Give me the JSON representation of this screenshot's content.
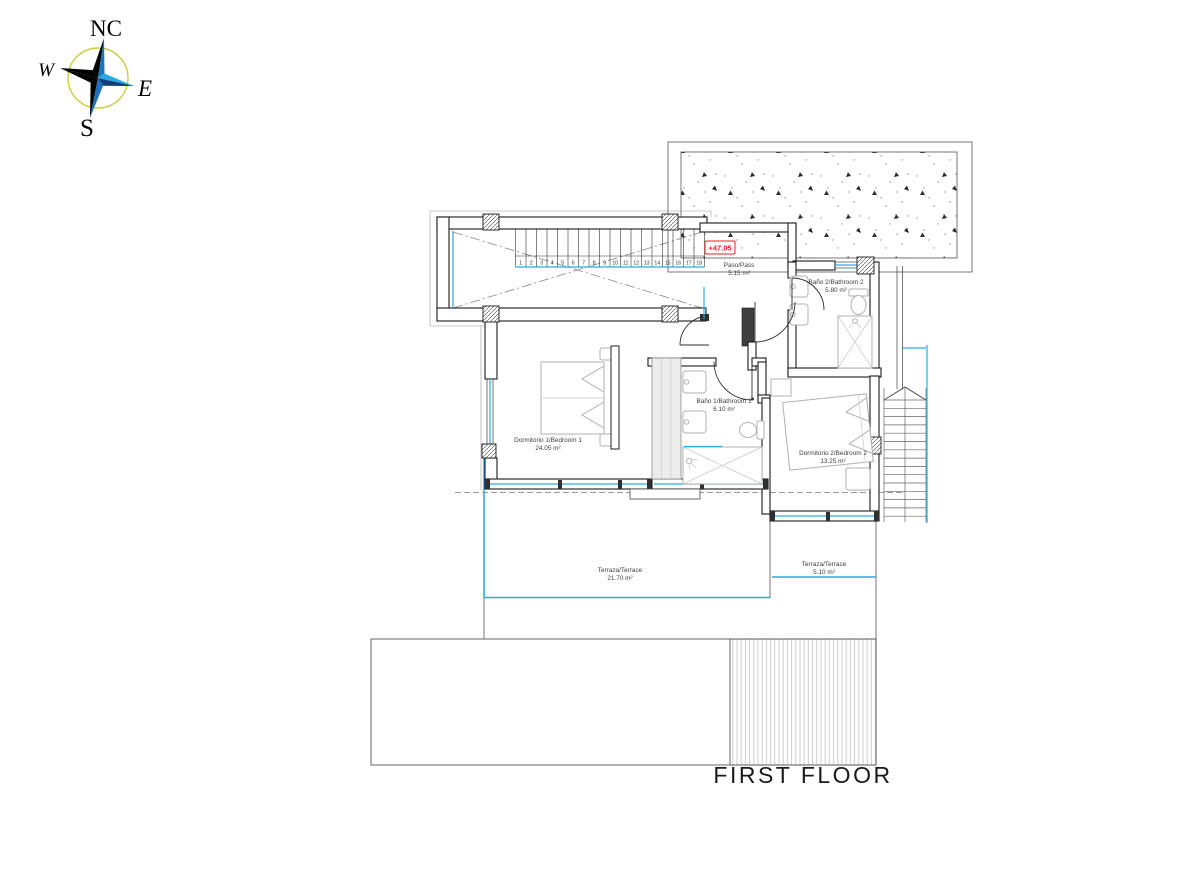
{
  "title": "FIRST FLOOR",
  "level_marker": "+47.05",
  "compass": {
    "north": "NC",
    "west": "W",
    "east": "E",
    "south": "S"
  },
  "rooms": {
    "paso": {
      "name": "Paso/Pass",
      "area": "5.15 m²"
    },
    "bathroom2": {
      "name": "Baño 2/Bathroom 2",
      "area": "5.80 m²"
    },
    "bedroom1": {
      "name": "Dormitorio 1/Bedroom 1",
      "area": "24.05 m²"
    },
    "bathroom1": {
      "name": "Baño 1/Bathroom 1",
      "area": "6.10 m²"
    },
    "bedroom2": {
      "name": "Dormitorio 2/Bedroom 2",
      "area": "13.25 m²"
    },
    "terrace_main": {
      "name": "Terraza/Terrace",
      "area": "21.70 m²"
    },
    "terrace_small": {
      "name": "Terraza/Terrace",
      "area": "5.10 m²"
    }
  },
  "stairs": {
    "step_numbers": [
      "1",
      "2",
      "3",
      "4",
      "5",
      "6",
      "7",
      "8",
      "9",
      "10",
      "11",
      "12",
      "13",
      "14",
      "15",
      "16",
      "17",
      "18"
    ]
  },
  "colors": {
    "glass_blue": "#29ABE2",
    "marker_red": "#FF1D25",
    "compass_ring_yellow": "#C9CE3B",
    "compass_dark_blue": "#1B75BC",
    "compass_light_blue": "#29ABE2"
  }
}
